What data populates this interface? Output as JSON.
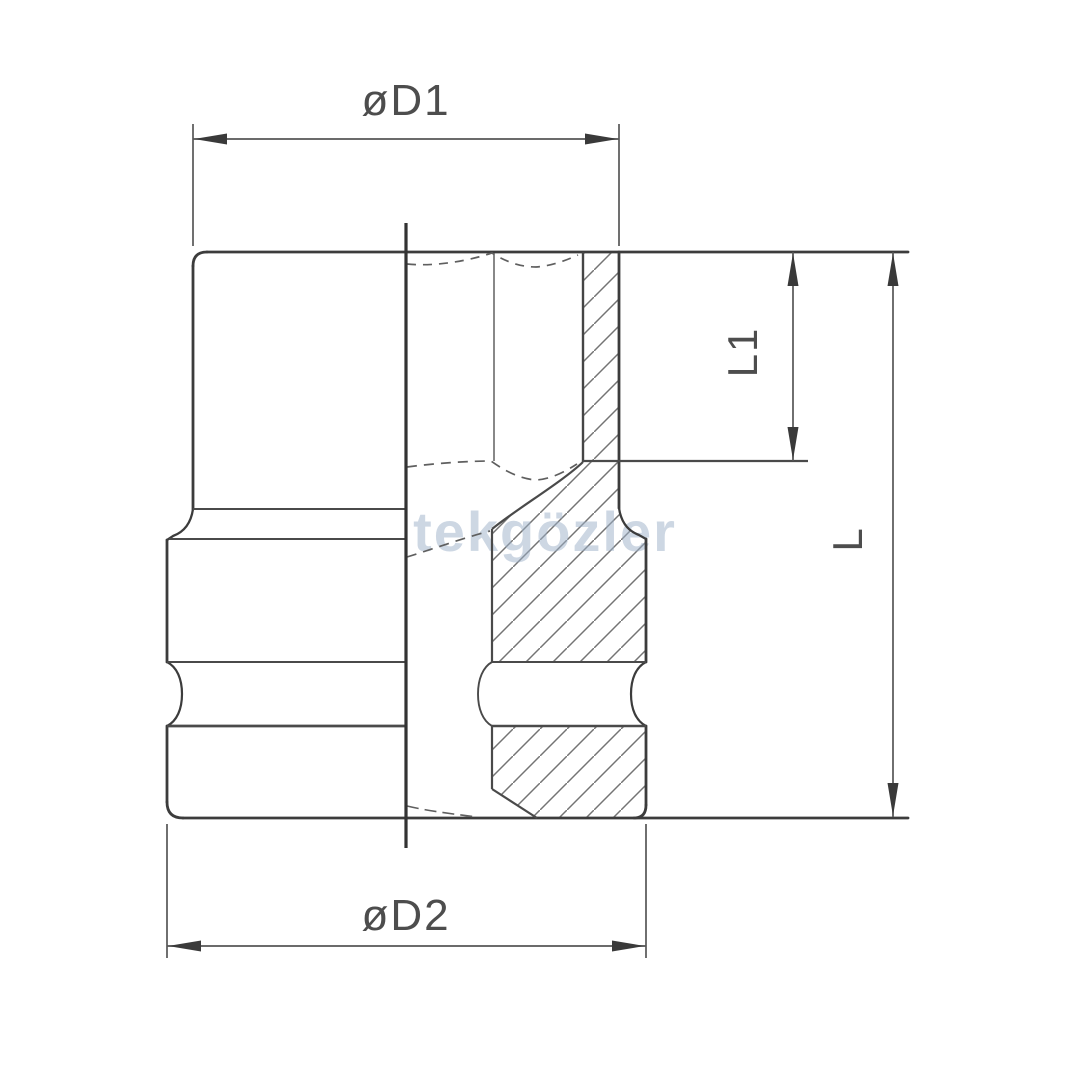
{
  "labels": {
    "d1": "øD1",
    "d2": "øD2",
    "l1": "L1",
    "l": "L"
  },
  "watermark": "tekgözler",
  "colors": {
    "outline": "#3c3c3c",
    "thin_line": "#5f5f5f",
    "hatch": "#747474",
    "dimension": "#555555",
    "label_text": "#4d4d4d",
    "watermark": "#9db1c9",
    "background": "#ffffff"
  }
}
